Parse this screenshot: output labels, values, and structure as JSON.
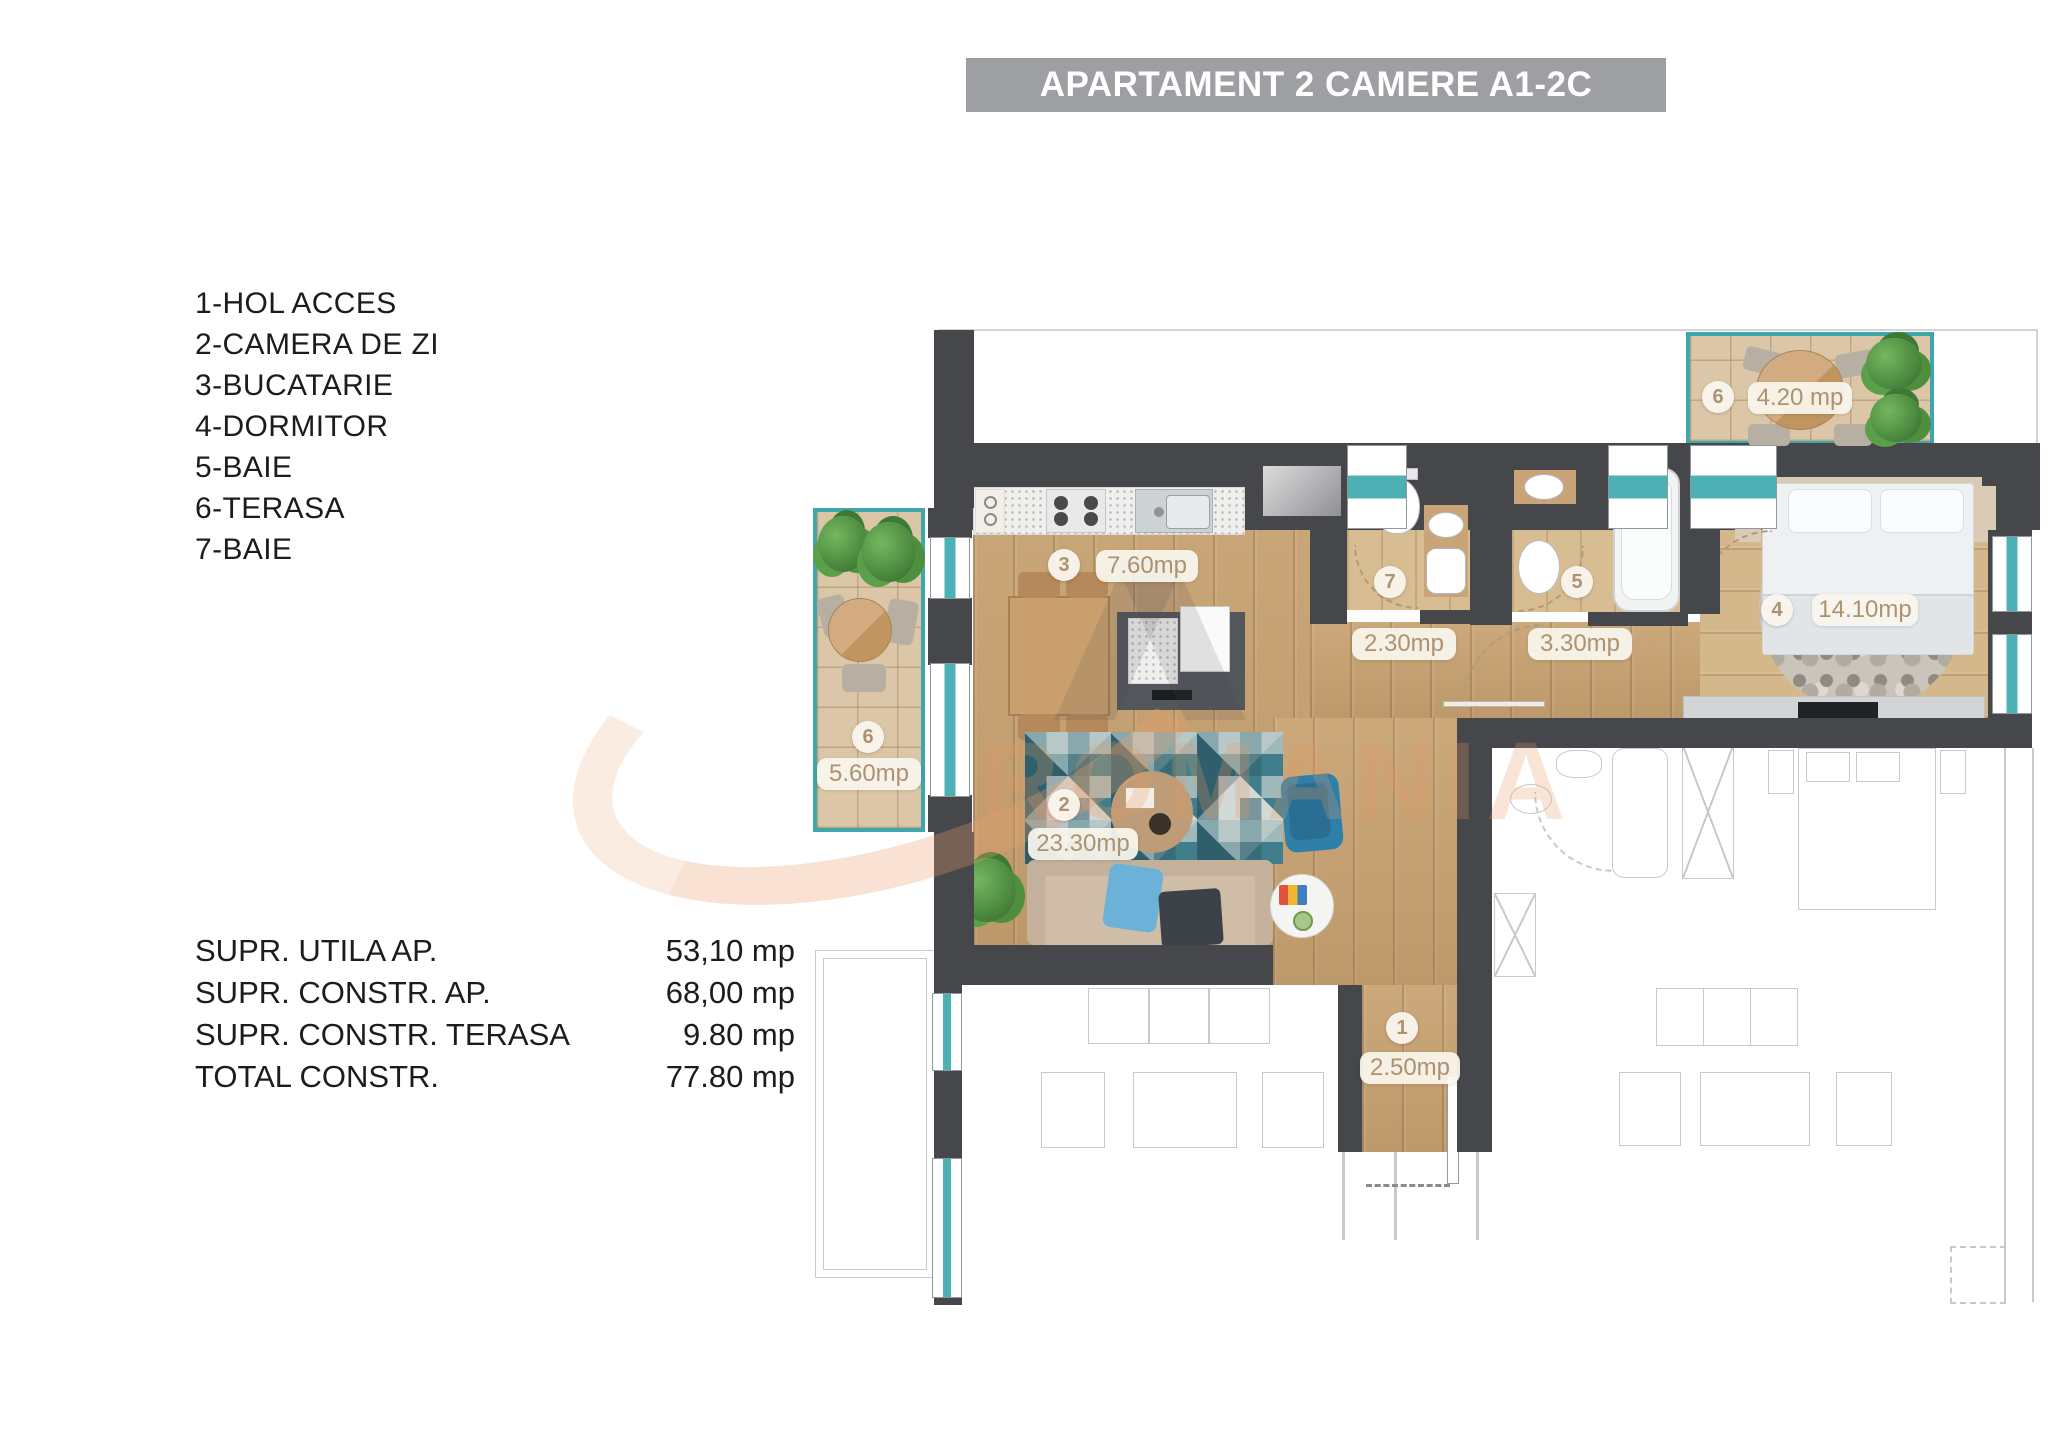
{
  "title": "APARTAMENT 2 CAMERE A1-2C",
  "legend": [
    "1-HOL ACCES",
    "2-CAMERA DE ZI",
    "3-BUCATARIE",
    "4-DORMITOR",
    "5-BAIE",
    "6-TERASA",
    "7-BAIE"
  ],
  "stats": {
    "rows": [
      {
        "label": "SUPR. UTILA AP.",
        "value": "53,10 mp"
      },
      {
        "label": "SUPR. CONSTR. AP.",
        "value": "68,00 mp"
      },
      {
        "label": "SUPR. CONSTR. TERASA",
        "value": "9.80 mp"
      },
      {
        "label": "TOTAL CONSTR.",
        "value": "77.80 mp"
      }
    ]
  },
  "rooms": {
    "hol": {
      "number": "1",
      "area": "2.50mp"
    },
    "camera_de_zi": {
      "number": "2",
      "area": "23.30mp"
    },
    "bucatarie": {
      "number": "3",
      "area": "7.60mp"
    },
    "dormitor": {
      "number": "4",
      "area": "14.10mp"
    },
    "baie5": {
      "number": "5",
      "area": "3.30mp"
    },
    "terasa_top": {
      "number": "6",
      "area": "4.20 mp"
    },
    "terasa_left": {
      "number": "6",
      "area": "5.60mp"
    },
    "baie7": {
      "number": "7",
      "area": "2.30mp"
    }
  },
  "watermark": {
    "text": "ROMANIA"
  },
  "colors": {
    "accent_teal": "#3fa6ab",
    "wall": "#46474b",
    "wood": "#c8a271",
    "title_bar": "#9d9fa2",
    "badge_text": "#ad9271",
    "watermark_orange": "#e89a64"
  }
}
